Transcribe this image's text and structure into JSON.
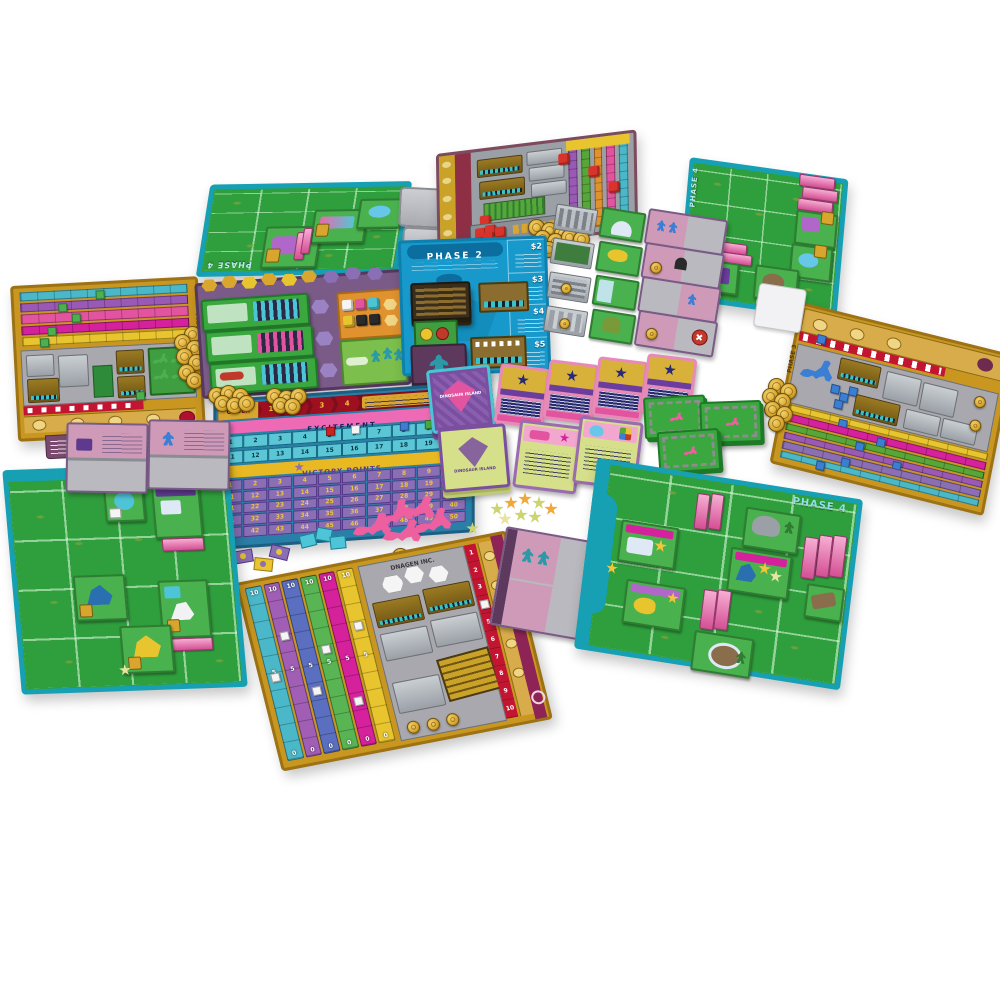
{
  "scene": {
    "type": "board-game-photo",
    "game_title": "DINOSAUR ISLAND",
    "background_color": "#ffffff",
    "description": "Full tabletop setup photographed on white: four player areas (green park board plus gold lab player mat each), central phase boards, score board, card rows, dice, coins, DNA chips, pink dinosaur meeples and visitor meeples."
  },
  "palette": {
    "board_green": "#2f9e3c",
    "water_teal": "#17a0b4",
    "phase2_blue": "#1899cc",
    "banner_blue": "#0b6e9e",
    "gold_frame": "#c9971f",
    "coin_gold": "#e3b33a",
    "maroon": "#8e2f46",
    "score_purple": "#8a6fb5",
    "pink_band": "#ef6ab4",
    "magenta": "#d6219c",
    "teal_track": "#4ab8c9",
    "purple_track": "#9b59b6",
    "yellow_track": "#e8c52e",
    "green_track": "#57a639",
    "blue_track": "#5b6fc0",
    "orange_panel": "#e0922f",
    "red_die": "#d9342b",
    "dino_pink": "#ee5fa0",
    "visitor_olive": "#ccd470",
    "visitor_orange": "#f0a838",
    "dna_chip_teal": "#4ec4d9",
    "cube_green": "#4caf50",
    "cube_blue": "#3b7fd4",
    "cube_red": "#cc2222",
    "cube_white": "#f5f5f5"
  },
  "labels": {
    "phase_1": "PHASE 1",
    "phase_2": "PHASE 2",
    "phase_3": "PHASE 3",
    "phase_4": "PHASE 4",
    "logo": "DINOSAUR ISLAND",
    "lab_name": "DNAGEN INC."
  },
  "phase2_board": {
    "title": "PHASE 2",
    "prices": [
      "$2",
      "$3",
      "$4",
      "$5"
    ]
  },
  "score_board": {
    "order_label": "ORDER",
    "order_numbers": [
      "1",
      "2",
      "3",
      "4"
    ],
    "excitement_label": "EXCITEMENT",
    "excitement_row1": [
      "1",
      "2",
      "3",
      "4",
      "5",
      "6",
      "7",
      "8",
      "9",
      "10"
    ],
    "excitement_row2": [
      "11",
      "12",
      "13",
      "14",
      "15",
      "16",
      "17",
      "18",
      "19",
      "20"
    ],
    "vp_label": "VICTORY POINTS",
    "vp_numbers": [
      "1",
      "2",
      "3",
      "4",
      "5",
      "6",
      "7",
      "8",
      "9",
      "10",
      "11",
      "12",
      "13",
      "14",
      "15",
      "16",
      "17",
      "18",
      "19",
      "20",
      "21",
      "22",
      "23",
      "24",
      "25",
      "26",
      "27",
      "28",
      "29",
      "30",
      "31",
      "32",
      "33",
      "34",
      "35",
      "36",
      "37",
      "38",
      "39",
      "40",
      "41",
      "42",
      "43",
      "44",
      "45",
      "46",
      "47",
      "48",
      "49",
      "50"
    ]
  },
  "player_mats": {
    "track_values": [
      "10",
      "5",
      "0"
    ],
    "threat_numbers": [
      "1",
      "2",
      "3",
      "4",
      "5",
      "6",
      "7",
      "8",
      "9",
      "10"
    ],
    "phase_tab": "PHASE 3",
    "lab_name": "DNAGEN INC."
  },
  "game_state": {
    "excitement_markers": [
      {
        "color": "#cc2222",
        "value": 5
      },
      {
        "color": "#f5f5f5",
        "value": 6
      },
      {
        "color": "#3b7fd4",
        "value": 8
      },
      {
        "color": "#44aa44",
        "value": 9
      }
    ],
    "left_mat_green_cubes": [
      0.45,
      0.22,
      0.3,
      0.15,
      0.1
    ],
    "right_mat_blue_cubes": [
      0.25,
      0.45,
      0.35,
      0.55,
      0.3,
      0.18
    ],
    "bottom_mat_white_cubes": [
      0.5,
      0.28,
      0.62,
      0.4,
      0.72,
      0.3
    ],
    "bottom_mat_threat_value": 4
  },
  "cards": {
    "objective_cards_face_up": 4,
    "contract_cards_face_up": 2,
    "specialist_cards_visible": 7,
    "paddock_tile_stacks": 3
  }
}
